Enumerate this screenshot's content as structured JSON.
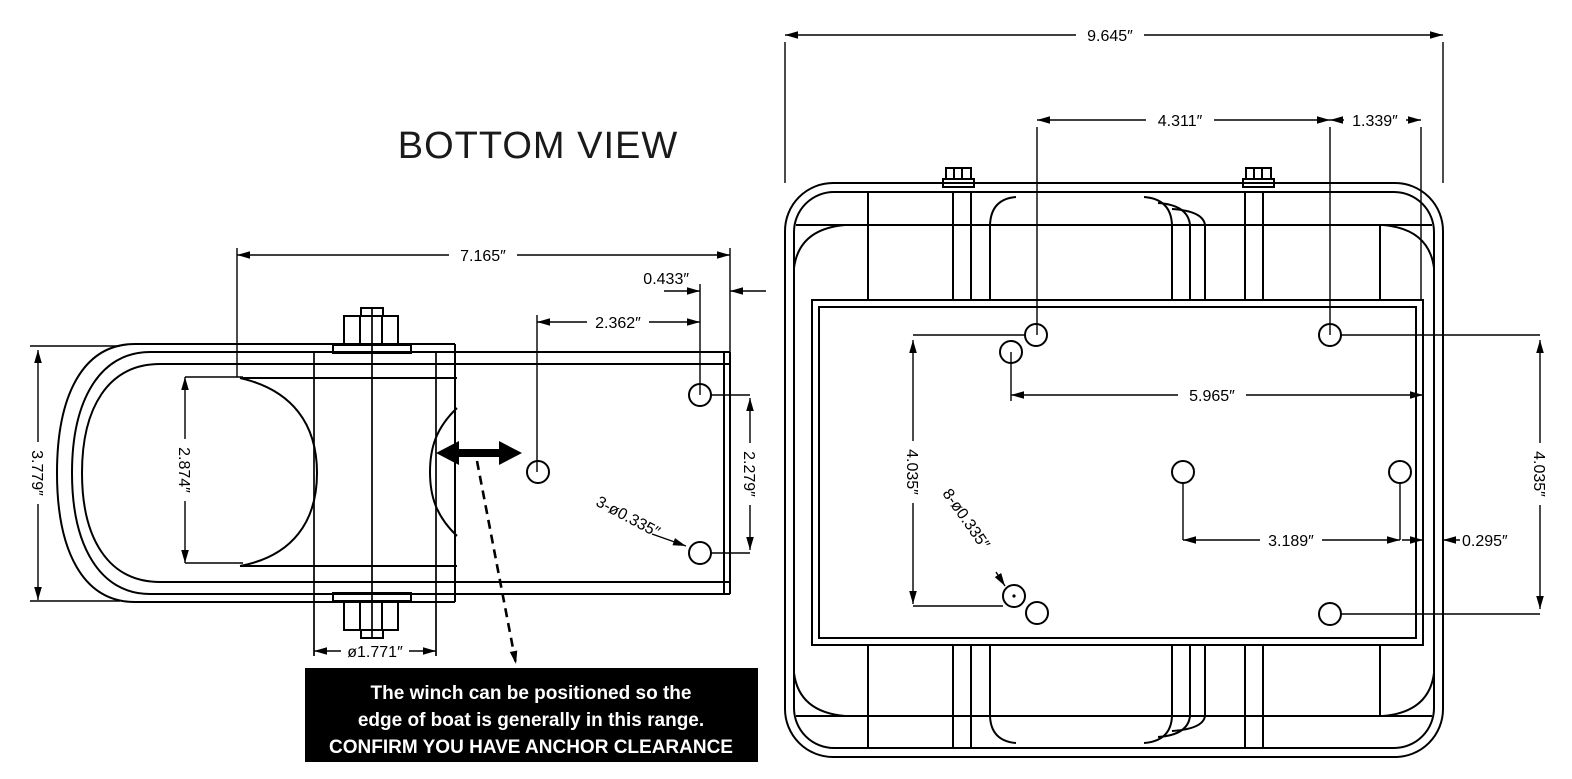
{
  "title": "BOTTOM VIEW",
  "note": {
    "line1": "The winch can be positioned so the",
    "line2": "edge of boat is generally in this range.",
    "line3": "CONFIRM YOU HAVE ANCHOR CLEARANCE"
  },
  "colors": {
    "ink": "#000000",
    "note_bg": "#000000",
    "note_text": "#ffffff"
  },
  "left_view": {
    "name": "winch bottom view",
    "dims": {
      "plate_width": "7.165″",
      "edge_offset": "0.433″",
      "hole_inset": "2.362″",
      "overall_height": "3.779″",
      "drum_width": "2.874″",
      "drum_diameter": "ø1.771″",
      "hole_vertical_span": "2.279″",
      "hole_callout": "3-ø0.335″"
    }
  },
  "right_view": {
    "name": "mounting frame bottom view",
    "dims": {
      "overall_width": "9.645″",
      "hole_span_top": "4.311″",
      "top_edge_offset": "1.339″",
      "hole_span_mid": "5.965″",
      "hole_col_height_left": "4.035″",
      "hole_callout": "8-ø0.335″",
      "hole_span_bottom": "3.189″",
      "plate_edge_offset": "0.295″",
      "hole_col_height_right": "4.035″"
    }
  }
}
